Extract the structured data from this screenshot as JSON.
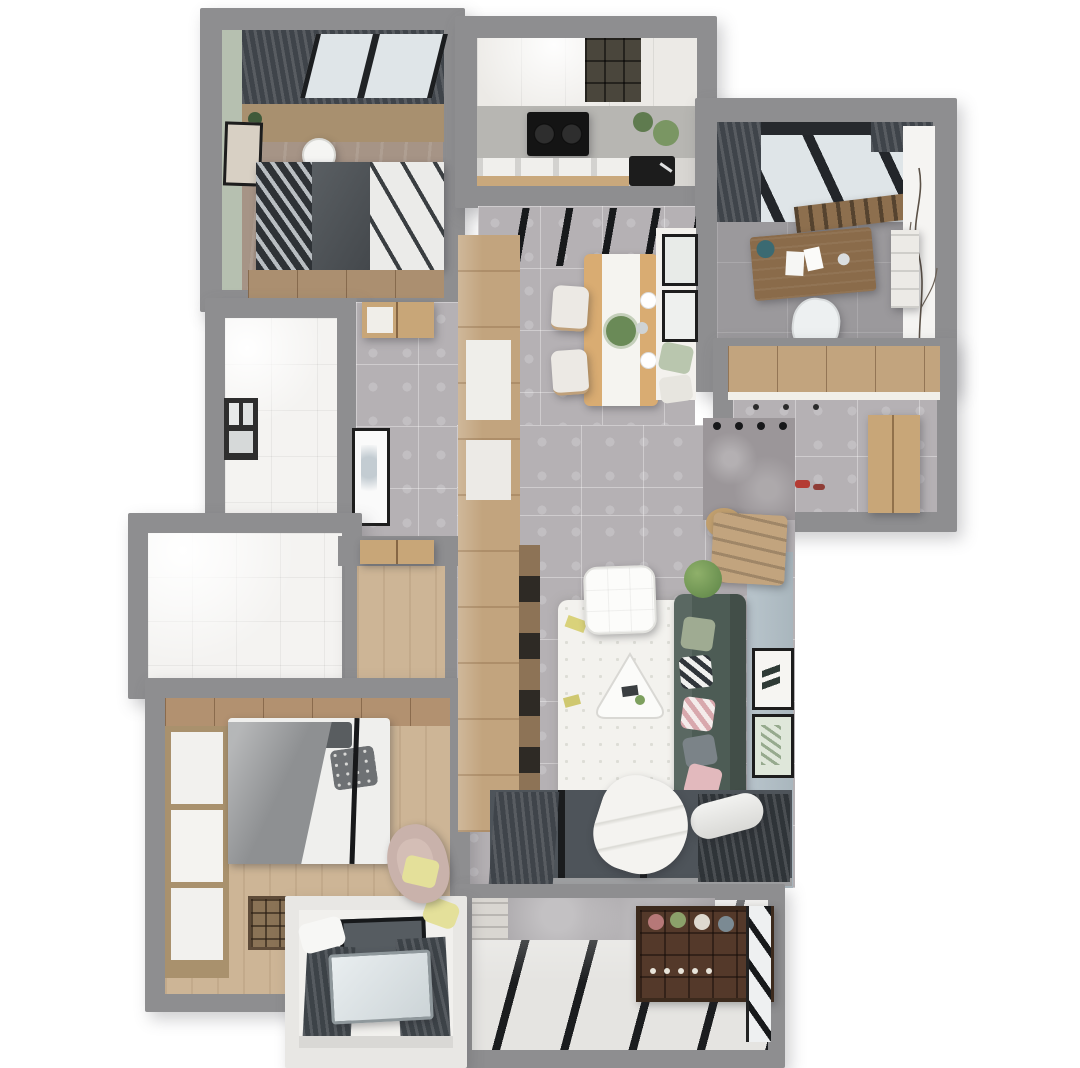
{
  "scene": {
    "label": "3D rendered apartment floor plan, top-down axonometric view",
    "style": "photorealistic dollhouse render on white background"
  },
  "palette": {
    "bg": "#ffffff",
    "wall": "#8e8e90",
    "tile": "#b5b1b4",
    "wood": "#c2a47e",
    "wood-dark": "#8d7356",
    "wood-floor": "#cdb596",
    "b1-floor": "#a69486",
    "green-wall": "#b6c0b0",
    "blue-wall": "#b6c2c9",
    "white-tile": "#f4f3f1",
    "sofa": "#4d5c55",
    "rug": "#f3f2ee",
    "curtain": "#3f444a",
    "glass": "#dfe5e8",
    "frame": "#1d1d1d",
    "study-floor": "#9b999c",
    "balcony-floor": "#e5e4e1",
    "stripe": "#1b1d1f",
    "cooktop": "#141414",
    "marble": "#9b9699",
    "counter": "#b7b6b2",
    "cabinet-white": "#eceae6",
    "bed-gray": "#8e9092",
    "bed-dark": "#34383c",
    "rack": "#54392a",
    "red": "#b43b33",
    "pink": "#e2b9bd",
    "leaf": "#6a8a57",
    "yellow": "#e4e09a"
  },
  "rooms": {
    "bedroom1": {
      "label": "Bedroom 1"
    },
    "kitchen": {
      "label": "Kitchen"
    },
    "study": {
      "label": "Study"
    },
    "dining": {
      "label": "Dining Area"
    },
    "hallway": {
      "label": "Hallway"
    },
    "bathroom1": {
      "label": "Bathroom"
    },
    "bathroom2": {
      "label": "Second Bathroom"
    },
    "bedroom2": {
      "label": "Master Bedroom"
    },
    "living": {
      "label": "Living Room"
    },
    "entry": {
      "label": "Entry Hall"
    },
    "balcony": {
      "label": "Balcony"
    },
    "bay": {
      "label": "Bay Window Nook"
    }
  },
  "furniture": {
    "bed1": "Double bed with dark bedding",
    "wardrobe1": "Wardrobe",
    "cooktop": "Gas cooktop",
    "sink": "Kitchen sink",
    "desk": "Writing desk",
    "deskChair": "Desk chair",
    "radiator": "Radiator",
    "diningTable": "Dining table with runner",
    "diningChair": "Dining chair",
    "sofa": "Green fabric sofa",
    "rug": "White shag rug",
    "pouf": "White pouf",
    "coffeeTable": "Triangular coffee table",
    "beanbag": "Bean bag",
    "bed2": "Double bed with grey duvet",
    "wardrobe2": "Built-in wardrobe",
    "cubeShelf": "Cube shelf",
    "armchair": "Blush armchair with yellow cushion",
    "wineRack": "Plant rack",
    "roller": "Rolled blind",
    "shoeCabinet": "Shoe cabinet",
    "entryDoor": "Entry door",
    "trackLights": "Track lights",
    "shoes": "Red shoes"
  }
}
